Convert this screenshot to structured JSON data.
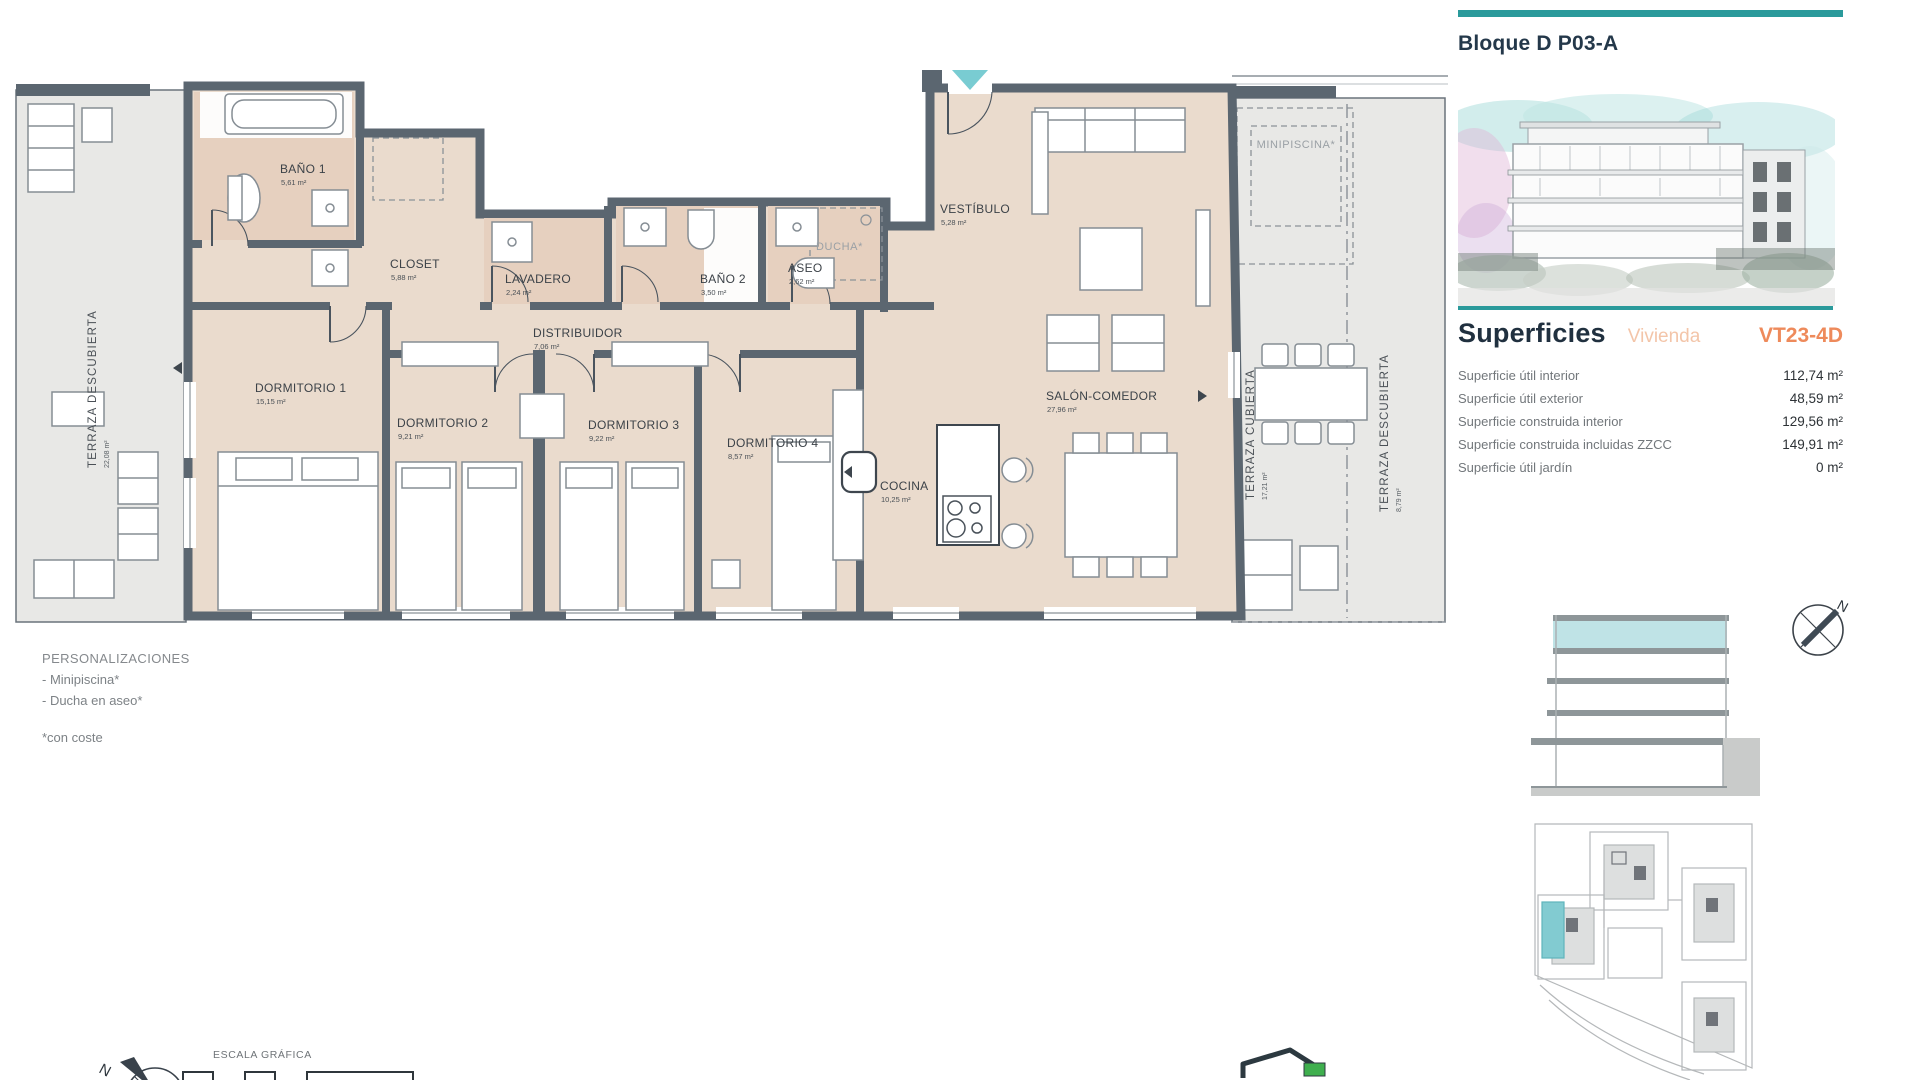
{
  "header": {
    "block_title": "Bloque D P03-A"
  },
  "superficies": {
    "title": "Superficies",
    "subtitle": "Vivienda",
    "unit_code": "VT23-4D",
    "rows": [
      {
        "label": "Superficie útil interior",
        "value": "112,74 m²"
      },
      {
        "label": "Superficie útil exterior",
        "value": "48,59 m²"
      },
      {
        "label": "Superficie construida interior",
        "value": "129,56 m²"
      },
      {
        "label": "Superficie construida incluidas ZZCC",
        "value": "149,91 m²"
      },
      {
        "label": "Superficie útil jardín",
        "value": "0 m²"
      }
    ]
  },
  "plan": {
    "rooms": {
      "bano1": {
        "name": "BAÑO 1",
        "area": "5,61 m²"
      },
      "closet": {
        "name": "CLOSET",
        "area": "5,88 m²"
      },
      "lavadero": {
        "name": "LAVADERO",
        "area": "2,24 m²"
      },
      "distribuidor": {
        "name": "DISTRIBUIDOR",
        "area": "7,06 m²"
      },
      "bano2": {
        "name": "BAÑO 2",
        "area": "3,50 m²"
      },
      "aseo": {
        "name": "ASEO",
        "area": "2,62 m²"
      },
      "ducha": {
        "name": "DUCHA*"
      },
      "vestibulo": {
        "name": "VESTÍBULO",
        "area": "5,28 m²"
      },
      "dormitorio1": {
        "name": "DORMITORIO 1",
        "area": "15,15 m²"
      },
      "dormitorio2": {
        "name": "DORMITORIO 2",
        "area": "9,21 m²"
      },
      "dormitorio3": {
        "name": "DORMITORIO 3",
        "area": "9,22 m²"
      },
      "dormitorio4": {
        "name": "DORMITORIO 4",
        "area": "8,57 m²"
      },
      "cocina": {
        "name": "COCINA",
        "area": "10,25 m²"
      },
      "salon": {
        "name": "SALÓN-COMEDOR",
        "area": "27,96 m²"
      },
      "minipiscina": {
        "name": "MINIPISCINA*"
      },
      "terraza_izq": {
        "name": "TERRAZA DESCUBIERTA",
        "area": "22,08 m²"
      },
      "terraza_cubierta": {
        "name": "TERRAZA CUBIERTA",
        "area": "17,21 m²"
      },
      "terraza_der": {
        "name": "TERRAZA DESCUBIERTA",
        "area": "8,79 m²"
      }
    }
  },
  "personalizaciones": {
    "title": "PERSONALIZACIONES",
    "items": [
      "- Minipiscina*",
      "- Ducha en aseo*"
    ],
    "footnote": "*con coste"
  },
  "scale": {
    "label": "ESCALA GRÁFICA"
  },
  "compass": {
    "north_label": "N"
  },
  "colors": {
    "accent_teal": "#2a9a9b",
    "accent_orange": "#ee8a5b",
    "light_orange": "#f3c5a9",
    "wall": "#5b6670",
    "floor_beige": "#eadbcd",
    "bath_tan": "#e6d0bf",
    "terrace_gray": "#e8e8e6",
    "highlight_teal": "#bfe3e6"
  }
}
